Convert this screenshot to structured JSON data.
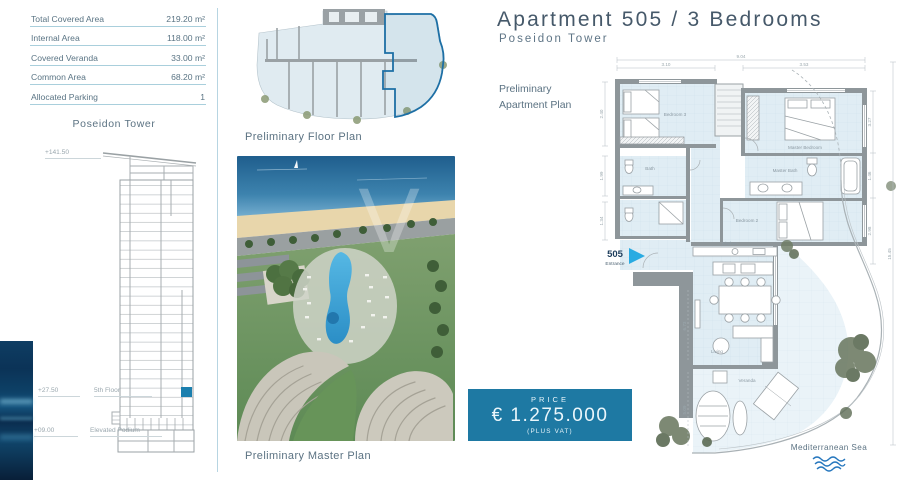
{
  "area_table": {
    "rows": [
      {
        "label": "Total Covered Area",
        "value": "219.20 m²"
      },
      {
        "label": "Internal Area",
        "value": "118.00 m²"
      },
      {
        "label": "Covered Veranda",
        "value": "33.00 m²"
      },
      {
        "label": "Common Area",
        "value": "68.20 m²"
      },
      {
        "label": "Allocated Parking",
        "value": "1"
      }
    ]
  },
  "tower": {
    "title": "Poseidon Tower",
    "annotations": [
      {
        "elev": "+141.50",
        "label": ""
      },
      {
        "elev": "+27.50",
        "label": "5th Floor"
      },
      {
        "elev": "+09.00",
        "label": "Elevated Podium"
      }
    ],
    "highlight_color": "#1b7fae"
  },
  "floor_plan": {
    "caption": "Preliminary Floor Plan",
    "highlight_color": "#1d6fa5"
  },
  "master_plan": {
    "caption": "Preliminary Master Plan",
    "watermark": "V"
  },
  "header": {
    "title": "Apartment 505 / 3 Bedrooms",
    "subtitle": "Poseidon Tower"
  },
  "apartment_plan": {
    "caption_line1": "Preliminary",
    "caption_line2": "Apartment Plan",
    "entrance": {
      "number": "505",
      "label": "Entrance"
    },
    "rooms": {
      "bedroom3": "Bedroom 3",
      "master_bedroom": "Master Bedroom",
      "master_bath": "Master Bath",
      "bedroom2": "Bedroom 2",
      "bath": "Bath",
      "kitchen": "Kitchen",
      "living": "Living",
      "veranda": "Veranda"
    },
    "dims": {
      "top_overall": "9.04",
      "top_left": "3.10",
      "top_right": "3.53",
      "left_1": "2.40",
      "left_2": "1.99",
      "left_3": "1.34",
      "right_1": "3.27",
      "right_2": "1.46",
      "right_3": "2.98",
      "right_overall": "15.45",
      "living_side": "6.73",
      "veranda_side": "5.09"
    },
    "sea_label": "Mediterranean Sea"
  },
  "price": {
    "label": "PRICE",
    "amount": "€ 1.275.000",
    "note": "(PLUS VAT)",
    "bg_color": "#1e79a3"
  },
  "colors": {
    "accent_teal": "#1e79a3",
    "highlight_blue": "#1b7fae",
    "table_rule": "#a9cfdc",
    "title_slate": "#46596a",
    "entrance_arrow": "#29abe2",
    "sea_wave": "#2878be"
  }
}
